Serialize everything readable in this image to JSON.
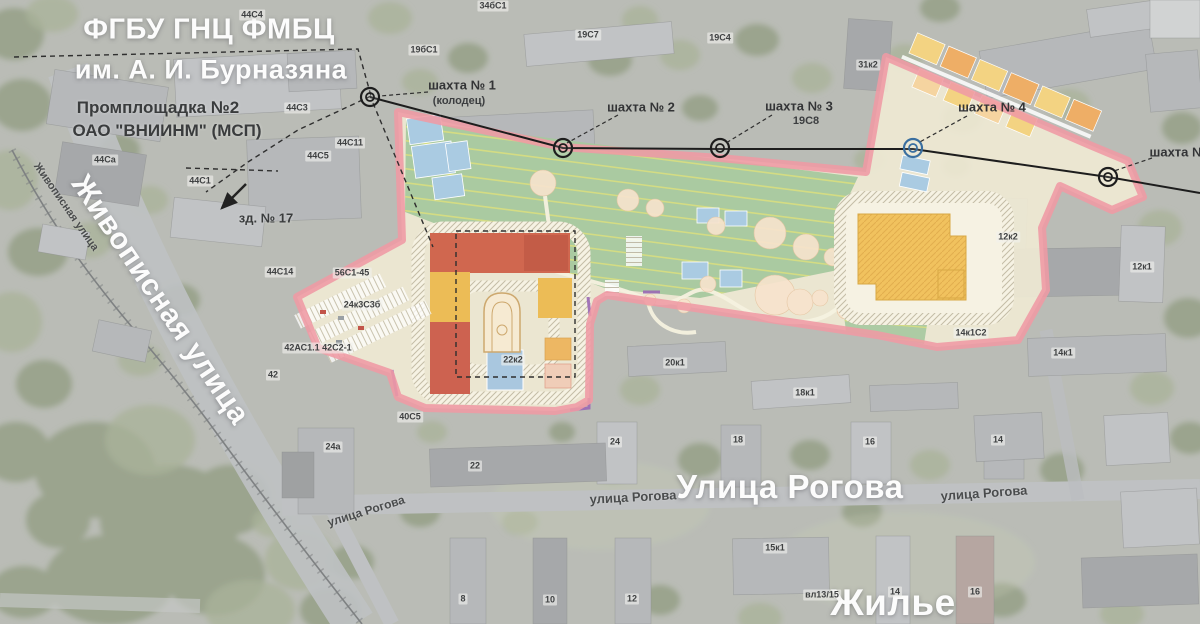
{
  "map": {
    "header": {
      "org_line1": "ФГБУ ГНЦ ФМБЦ",
      "org_line2": "им. А. И. Бурназяна",
      "site_line1": "Промплощадка №2",
      "site_line2": "ОАО \"ВНИИНМ\" (МСП)"
    },
    "annotations": {
      "building_note": "зд. № 17"
    },
    "streets_large": [
      {
        "id": "zhivopisnaya",
        "text": "Живописная улица"
      },
      {
        "id": "rogova",
        "text": "Улица Рогова"
      },
      {
        "id": "zhilyo",
        "text": "Жилье"
      }
    ],
    "streets_small": [
      {
        "t": "Живописная улица",
        "x": 66,
        "y": 207,
        "rot": 55,
        "size": 11
      },
      {
        "t": "улица Рогова",
        "x": 366,
        "y": 511,
        "rot": -17,
        "size": 12
      },
      {
        "t": "улица Рогова",
        "x": 633,
        "y": 497,
        "rot": -3,
        "size": 13
      },
      {
        "t": "улица Рогова",
        "x": 984,
        "y": 493,
        "rot": -4,
        "size": 13
      }
    ],
    "shafts": [
      {
        "label": "шахта № 1",
        "sublabel": "(колодец)",
        "cx": 370,
        "cy": 97,
        "lx": 462,
        "ly": 85,
        "sx": 459,
        "sy": 101,
        "ring": "#1d1d1d",
        "leader": [
          428,
          92,
          380,
          96
        ]
      },
      {
        "label": "шахта № 2",
        "sublabel": "",
        "cx": 563,
        "cy": 148,
        "lx": 641,
        "ly": 107,
        "sx": 0,
        "sy": 0,
        "ring": "#1d1d1d",
        "leader": [
          618,
          115,
          567,
          143
        ]
      },
      {
        "label": "шахта № 3",
        "sublabel": "19С8",
        "cx": 720,
        "cy": 148,
        "lx": 799,
        "ly": 106,
        "sx": 806,
        "sy": 121,
        "ring": "#1d1d1d",
        "leader": [
          772,
          115,
          726,
          143
        ]
      },
      {
        "label": "шахта № 4",
        "sublabel": "",
        "cx": 913,
        "cy": 148,
        "lx": 992,
        "ly": 107,
        "sx": 0,
        "sy": 0,
        "ring": "#3a6fa0",
        "leader": [
          967,
          116,
          918,
          143
        ]
      },
      {
        "label": "шахта №",
        "sublabel": "",
        "cx": 1108,
        "cy": 177,
        "lx": 1178,
        "ly": 152,
        "sx": 0,
        "sy": 0,
        "ring": "#1d1d1d",
        "leader": [
          1152,
          158,
          1114,
          171
        ]
      }
    ],
    "building_labels": [
      {
        "t": "44С4",
        "x": 252,
        "y": 15
      },
      {
        "t": "34бС1",
        "x": 493,
        "y": 6
      },
      {
        "t": "19бС1",
        "x": 424,
        "y": 50
      },
      {
        "t": "19С7",
        "x": 588,
        "y": 35
      },
      {
        "t": "19С4",
        "x": 720,
        "y": 38
      },
      {
        "t": "31к2",
        "x": 868,
        "y": 65
      },
      {
        "t": "44С3",
        "x": 297,
        "y": 108
      },
      {
        "t": "44С11",
        "x": 350,
        "y": 143
      },
      {
        "t": "44С5",
        "x": 318,
        "y": 156
      },
      {
        "t": "44Са",
        "x": 105,
        "y": 160
      },
      {
        "t": "44С1",
        "x": 200,
        "y": 181
      },
      {
        "t": "44С14",
        "x": 280,
        "y": 272
      },
      {
        "t": "56С1-45",
        "x": 352,
        "y": 273
      },
      {
        "t": "24к3С3б",
        "x": 362,
        "y": 305
      },
      {
        "t": "42АС1.1 42С2-1",
        "x": 318,
        "y": 348
      },
      {
        "t": "42",
        "x": 273,
        "y": 375
      },
      {
        "t": "22к2",
        "x": 513,
        "y": 360
      },
      {
        "t": "20к1",
        "x": 675,
        "y": 363
      },
      {
        "t": "18к1",
        "x": 805,
        "y": 393
      },
      {
        "t": "14к1С2",
        "x": 971,
        "y": 333
      },
      {
        "t": "14к1",
        "x": 1063,
        "y": 353
      },
      {
        "t": "12к2",
        "x": 1008,
        "y": 237
      },
      {
        "t": "12к1",
        "x": 1142,
        "y": 267
      },
      {
        "t": "24а",
        "x": 333,
        "y": 447
      },
      {
        "t": "40С5",
        "x": 410,
        "y": 417
      },
      {
        "t": "22",
        "x": 475,
        "y": 466
      },
      {
        "t": "24",
        "x": 615,
        "y": 442
      },
      {
        "t": "18",
        "x": 738,
        "y": 440
      },
      {
        "t": "16",
        "x": 870,
        "y": 442
      },
      {
        "t": "14",
        "x": 998,
        "y": 440
      },
      {
        "t": "8",
        "x": 463,
        "y": 599
      },
      {
        "t": "10",
        "x": 550,
        "y": 600
      },
      {
        "t": "12",
        "x": 632,
        "y": 599
      },
      {
        "t": "15к1",
        "x": 775,
        "y": 548
      },
      {
        "t": "вл13/15",
        "x": 822,
        "y": 595
      },
      {
        "t": "14",
        "x": 895,
        "y": 592
      },
      {
        "t": "16",
        "x": 975,
        "y": 592
      }
    ],
    "colors": {
      "plan_outline": "#ef9aa4",
      "plan_base": "#efe9d4",
      "field_green": "#a6c89e",
      "track_stripe": "#dce07e",
      "building_red": "#d0674f",
      "building_yellow": "#ecbc56",
      "school_yellow": "#f1c25e",
      "water_blue": "#aacbe2",
      "accent_purple": "#9a68b5",
      "marker_blue": "#3a6fa0",
      "label_dark": "#3a3c3d",
      "label_light": "#ffffff"
    }
  }
}
